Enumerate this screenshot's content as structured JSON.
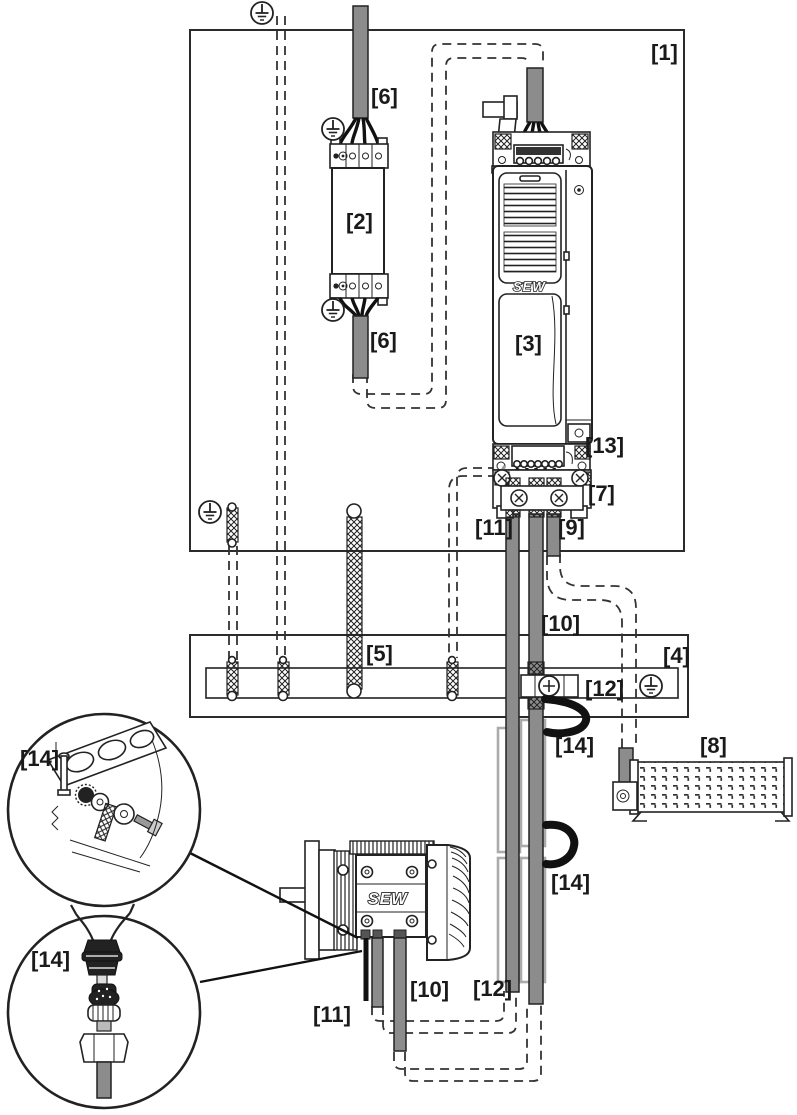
{
  "labels": {
    "cabinet": "[1]",
    "filter": "[2]",
    "inverter": "[3]",
    "rail": "[4]",
    "strap": "[5]",
    "cable6_top": "[6]",
    "cable6_bottom": "[6]",
    "shield_clamp": "[7]",
    "tray": "[8]",
    "cable9": "[9]",
    "cable10_top": "[10]",
    "cable10_bottom": "[10]",
    "cable11_top": "[11]",
    "cable11_bottom": "[11]",
    "clamp12_rail": "[12]",
    "clamp12_bottom": "[12]",
    "terminal13": "[13]",
    "loop14_upper": "[14]",
    "loop14_lower": "[14]",
    "callout14_top": "[14]",
    "callout14_bottom": "[14]"
  },
  "brand": {
    "inverter": "SEW",
    "motor": "SEW"
  },
  "icons": {
    "protective_earth_symbol": "⏚",
    "clamp_screw": "⊗",
    "rail_screw": "⊕"
  },
  "colors": {
    "cable_gray": "#8c8c8c",
    "line": "#222222",
    "loop_black": "#111111",
    "duct_gray": "#ababab",
    "background": "#ffffff"
  }
}
